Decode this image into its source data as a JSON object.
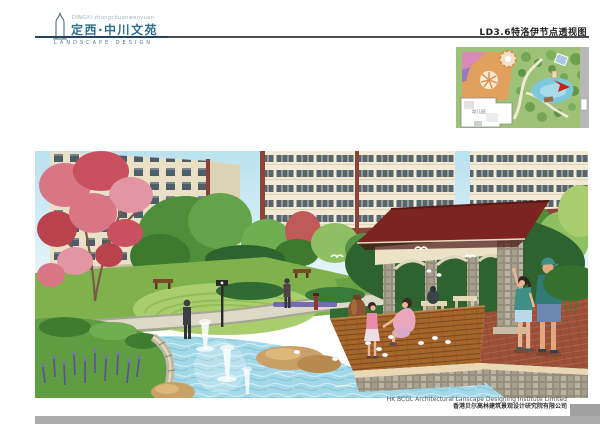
{
  "header": {
    "brand_small": "DINGXI·zhongchuanwenyuan",
    "title": "定西·中川文苑",
    "subtitle": "LANDSCAPE DESIGN",
    "sheet_title": "LD3.6特洛伊节点透视图"
  },
  "inset_map": {
    "building_label": "幼儿园"
  },
  "footer": {
    "company_en": "HK BCGL Architectural Lanscape Designing Institute Limited",
    "company_cn": "香港贝尔高林建筑景观设计研究院有限公司"
  },
  "palette": {
    "header_blue": "#2f6f8f",
    "rule_gray": "#4c4c4c",
    "pavilion_roof_red": "#7c2420",
    "water_blue": "#a2d8e8",
    "deck_brown": "#a5662a",
    "lawn_green": "#7fb24d",
    "paving_red": "#9c5038",
    "bottom_bar_gray": "#ababab",
    "locator_arrow_red": "#cc2211"
  }
}
